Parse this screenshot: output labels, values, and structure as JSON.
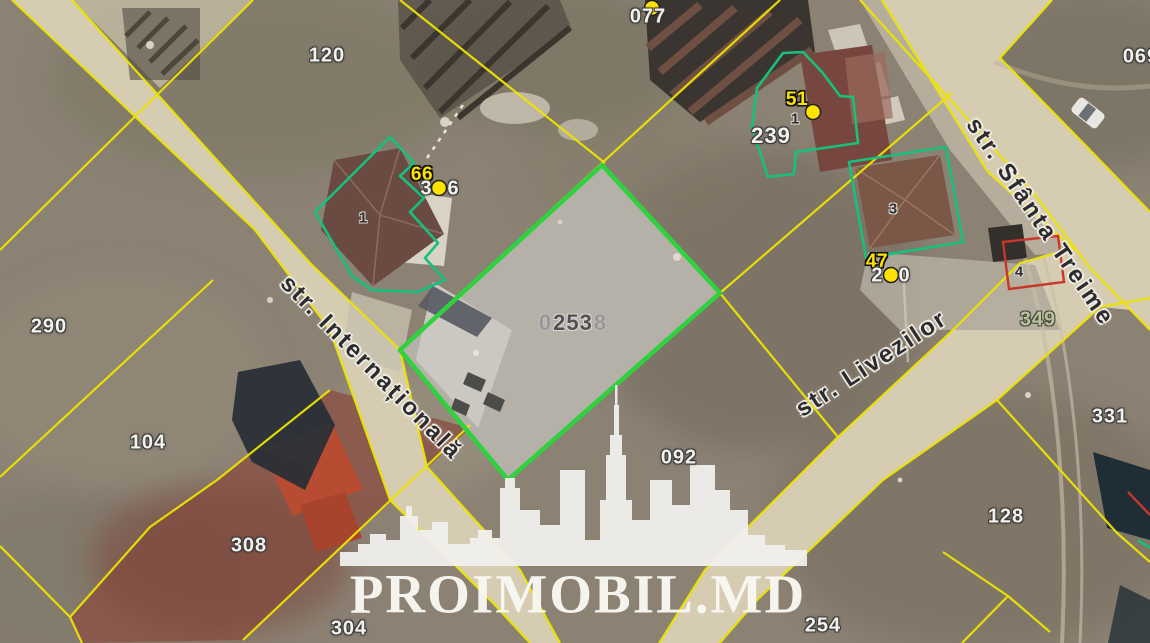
{
  "watermark": {
    "brand": "PROIMOBIL.MD"
  },
  "streets": {
    "internationala": "str. Internațională",
    "sfanta_treime": "str. Sfânta Treime",
    "livezilor": "str. Livezilor"
  },
  "parcel_labels": {
    "p077": "077",
    "p120": "120",
    "p069": "069",
    "p290": "290",
    "p104": "104",
    "p308": "308",
    "p304": "304",
    "p254": "254",
    "p128": "128",
    "p331": "331",
    "p349": "349",
    "p239": "239",
    "p092": "092"
  },
  "central_parcel": {
    "prefix": "0",
    "main": "253",
    "suffix": "8"
  },
  "point_badges": {
    "b66": "66",
    "b51": "51",
    "b47": "47"
  },
  "house_numbers": {
    "h66": "1",
    "h51": "1",
    "h3": "3",
    "h4": "4"
  },
  "split_numbers": {
    "n306_left": "3",
    "n306_right": "6",
    "n290_left": "2",
    "n290_right": "0"
  },
  "colors": {
    "featured_green": "#2fd23e",
    "cadastral_yellow": "#ece400",
    "outline_teal": "#17c07c",
    "restriction_red": "#c8372a",
    "marker_yellow": "#ffe300",
    "road_tan": "#d6ccb2",
    "field_brown": "#8b8274",
    "parcel_gray": "#b6b2a9",
    "watermark_white": "#f2f1ed"
  }
}
